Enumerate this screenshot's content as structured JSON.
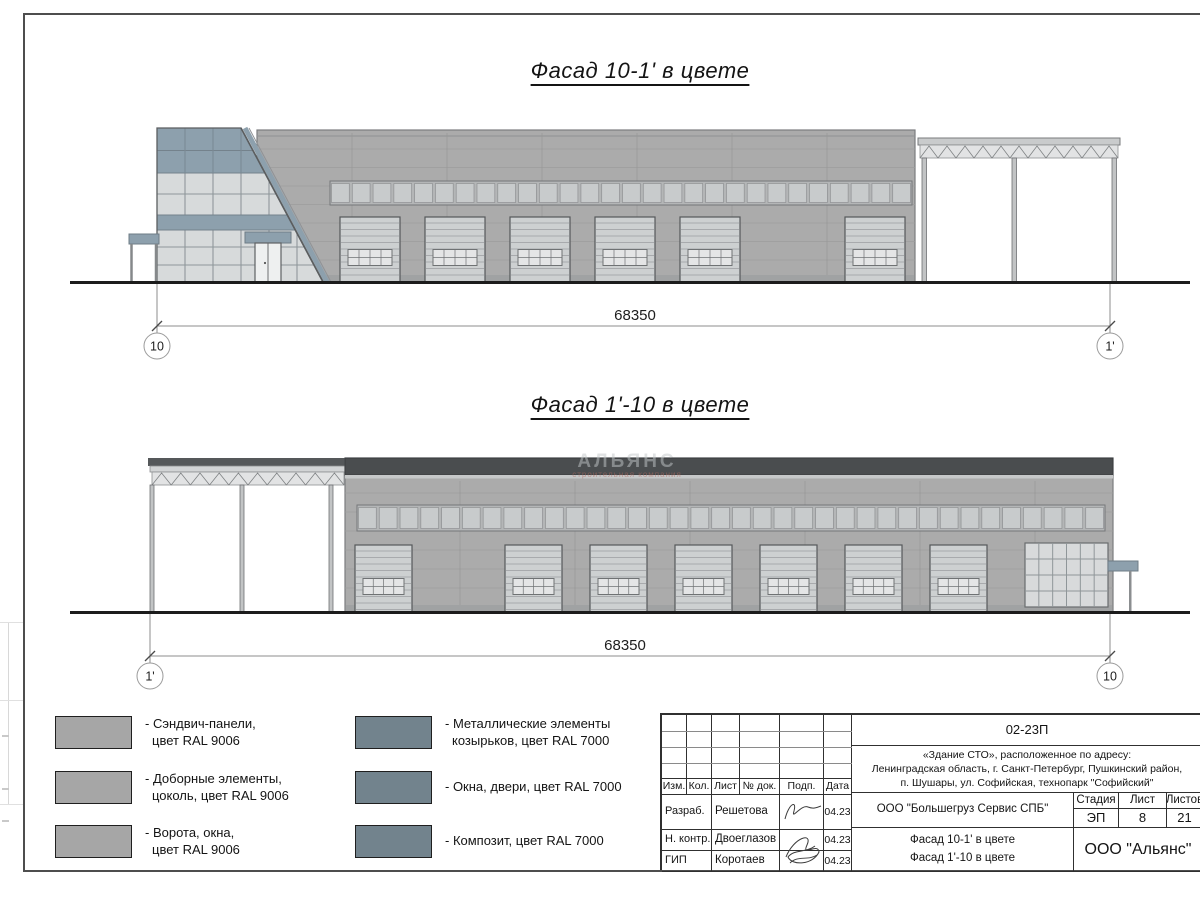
{
  "facade1": {
    "title": "Фасад 10-1' в цвете",
    "dim": "68350",
    "axis_left": "10",
    "axis_right": "1'"
  },
  "facade2": {
    "title": "Фасад 1'-10 в цвете",
    "dim": "68350",
    "axis_left": "1'",
    "axis_right": "10"
  },
  "watermark": {
    "brand": "АЛЬЯНС",
    "tagline": "строительная компания"
  },
  "legend": {
    "items": [
      {
        "line1": "- Сэндвич-панели,",
        "line2": "цвет RAL 9006",
        "color": "#a6a6a6"
      },
      {
        "line1": "- Доборные элементы,",
        "line2": "цоколь, цвет RAL 9006",
        "color": "#a6a6a6"
      },
      {
        "line1": "- Ворота, окна,",
        "line2": "цвет RAL 9006",
        "color": "#a6a6a6"
      },
      {
        "line1": "- Металлические элементы",
        "line2": "козырьков, цвет RAL 7000",
        "color": "#72838d"
      },
      {
        "line1": "- Окна, двери, цвет RAL 7000",
        "line2": "",
        "color": "#72838d"
      },
      {
        "line1": "- Композит, цвет RAL 7000",
        "line2": "",
        "color": "#72838d"
      }
    ]
  },
  "titleblock": {
    "doc_number": "02-23П",
    "address_line1": "«Здание СТО», расположенное по адресу:",
    "address_line2": "Ленинградская область, г. Санкт-Петербург, Пушкинский район,",
    "address_line3": "п. Шушары, ул. Софийская, технопарк \"Софийский\"",
    "col_izm": "Изм.",
    "col_kol": "Кол.",
    "col_list": "Лист",
    "col_doc": "№ док.",
    "col_podp": "Подп.",
    "col_data": "Дата",
    "row1_role": "Разраб.",
    "row1_name": "Решетова",
    "row1_date": "04.23",
    "row2_role": "Н. контр.",
    "row2_name": "Двоеглазов",
    "row2_date": "04.23",
    "row3_role": "ГИП",
    "row3_name": "Коротаев",
    "row3_date": "04.23",
    "company": "ООО \"Большегруз Сервис СПБ\"",
    "stage_label": "Стадия",
    "sheet_label": "Лист",
    "sheets_label": "Листов",
    "stage_value": "ЭП",
    "sheet_value": "8",
    "sheets_value": "21",
    "content_line1": "Фасад 10-1' в цвете",
    "content_line2": "Фасад 1'-10 в цвете",
    "org": "ООО \"Альянс\""
  },
  "colors": {
    "accent": "#8da0ad",
    "wall": "#ababab",
    "parapet": "#4a4d4f",
    "ral9006": "#a6a6a6",
    "ral7000": "#72838d"
  }
}
